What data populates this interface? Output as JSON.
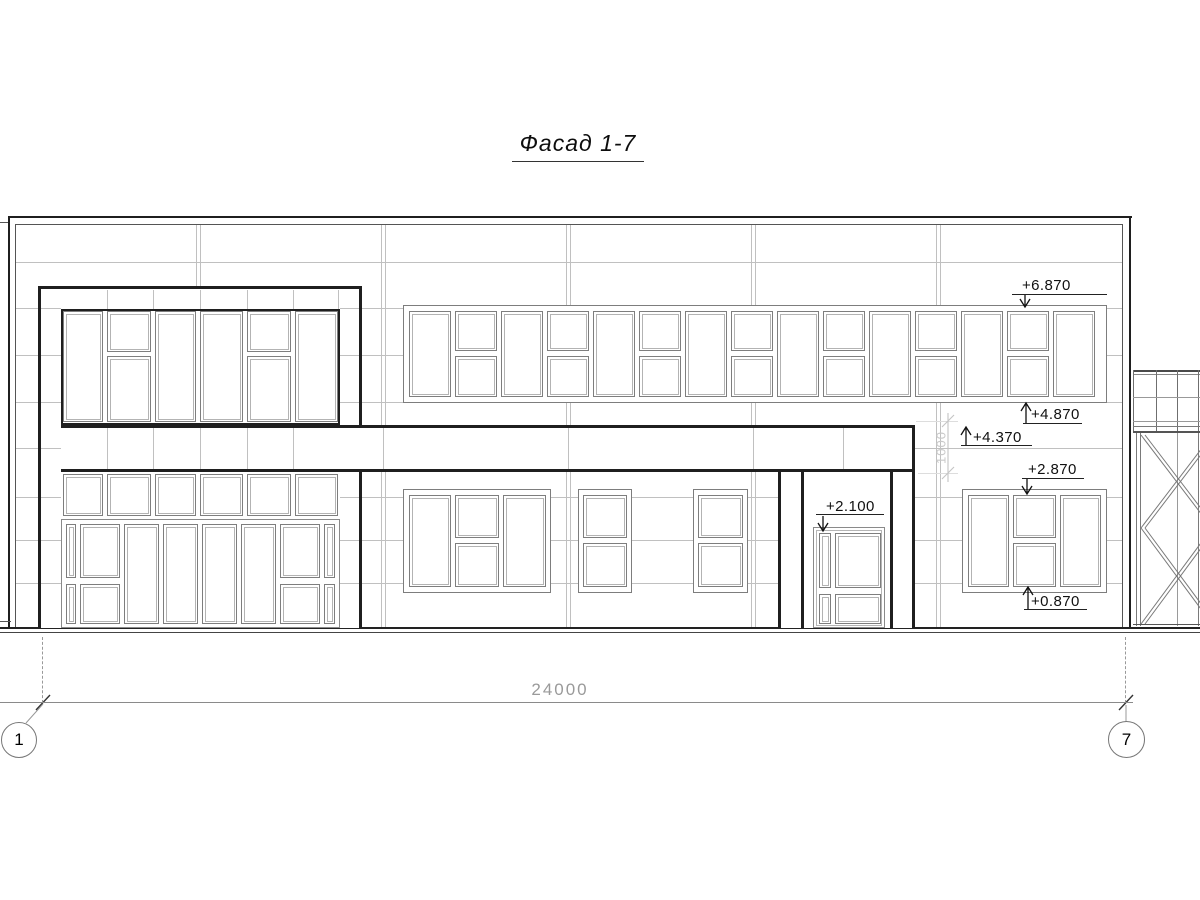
{
  "title": "Фасад 1-7",
  "elevation_marks": {
    "ribbon_top": "+6.870",
    "ribbon_bottom": "+4.870",
    "band_top": "+4.370",
    "window_top": "+2.870",
    "door_top": "+2.100",
    "window_bottom": "+0.870"
  },
  "dimensions": {
    "overall_width": "24000",
    "band_offset": "1000"
  },
  "grid_axes": {
    "left": "1",
    "right": "7"
  },
  "colors": {
    "line_dark": "#1a1a1a",
    "line_mid": "#7d7d7d",
    "line_light": "#bdbdbd",
    "dim_grey": "#9a9a9a",
    "paper": "#ffffff"
  }
}
